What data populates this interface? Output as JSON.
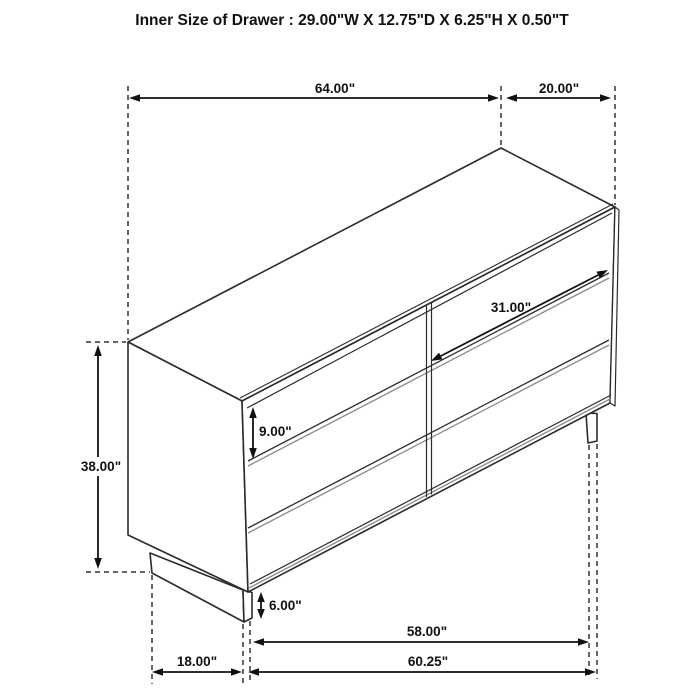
{
  "title": "Inner Size of Drawer : 29.00\"W X 12.75\"D X 6.25\"H X 0.50\"T",
  "dimensions": {
    "overall_width": "64.00\"",
    "top_depth": "20.00\"",
    "drawer_width": "31.00\"",
    "drawer_height": "9.00\"",
    "overall_height": "38.00\"",
    "base_height": "6.00\"",
    "leg_span_inner": "58.00\"",
    "leg_span_outer": "60.25\"",
    "side_depth": "18.00\""
  },
  "colors": {
    "line": "#2b2b2b",
    "shade": "#8a8a8a",
    "text": "#111111",
    "background": "#ffffff"
  }
}
